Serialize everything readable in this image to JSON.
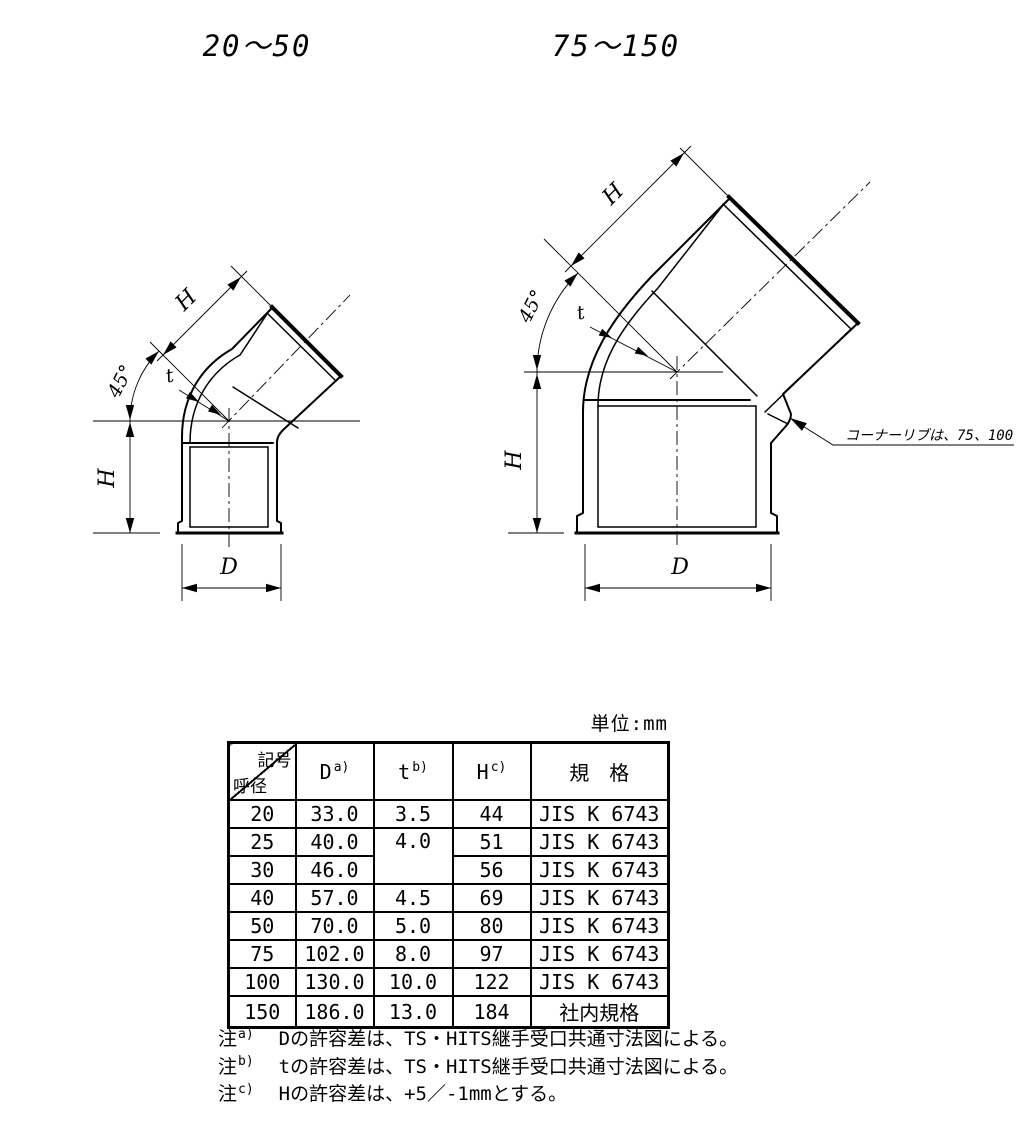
{
  "figures": {
    "left": {
      "title": "20〜50",
      "labels": {
        "h_diag": "H",
        "angle": "45°",
        "t": "t",
        "h_vert": "H",
        "d": "D"
      }
    },
    "right": {
      "title": "75〜150",
      "labels": {
        "h_diag": "H",
        "angle": "45°",
        "t": "t",
        "h_vert": "H",
        "d": "D"
      },
      "rib_note": "コーナーリブは、75、100"
    }
  },
  "table": {
    "unit_label": "単位:mm",
    "header": {
      "corner_top": "記号",
      "corner_bottom": "呼径",
      "col_d": {
        "base": "D",
        "sup": "a)"
      },
      "col_t": {
        "base": "t",
        "sup": "b)"
      },
      "col_h": {
        "base": "H",
        "sup": "c)"
      },
      "col_std": "規　格"
    },
    "rows": [
      {
        "dn": "20",
        "d": "33.0",
        "t": "3.5",
        "h": "44",
        "std": "JIS K 6743"
      },
      {
        "dn": "25",
        "d": "40.0",
        "t": "4.0",
        "h": "51",
        "std": "JIS K 6743"
      },
      {
        "dn": "30",
        "d": "46.0",
        "h": "56",
        "std": "JIS K 6743"
      },
      {
        "dn": "40",
        "d": "57.0",
        "t": "4.5",
        "h": "69",
        "std": "JIS K 6743"
      },
      {
        "dn": "50",
        "d": "70.0",
        "t": "5.0",
        "h": "80",
        "std": "JIS K 6743"
      },
      {
        "dn": "75",
        "d": "102.0",
        "t": "8.0",
        "h": "97",
        "std": "JIS K 6743"
      },
      {
        "dn": "100",
        "d": "130.0",
        "t": "10.0",
        "h": "122",
        "std": "JIS K 6743"
      },
      {
        "dn": "150",
        "d": "186.0",
        "t": "13.0",
        "h": "184",
        "std": "社内規格"
      }
    ]
  },
  "notes": [
    {
      "mark": "注",
      "sup": "a)",
      "text": "Dの許容差は、TS・HITS継手受口共通寸法図による。"
    },
    {
      "mark": "注",
      "sup": "b)",
      "text": "tの許容差は、TS・HITS継手受口共通寸法図による。"
    },
    {
      "mark": "注",
      "sup": "c)",
      "text": "Hの許容差は、+5／-1mmとする。"
    }
  ],
  "colors": {
    "line": "#000000",
    "background": "#ffffff"
  }
}
